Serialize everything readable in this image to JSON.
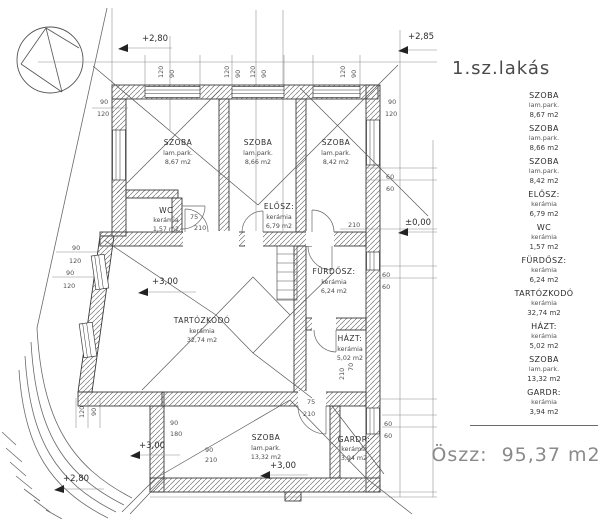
{
  "title": "1.sz.lakás",
  "plan": {
    "rooms": [
      {
        "name": "SZOBA",
        "material": "lam.park.",
        "area": "8,67  m2"
      },
      {
        "name": "SZOBA",
        "material": "lam.park.",
        "area": "8,66  m2"
      },
      {
        "name": "SZOBA",
        "material": "lam.park.",
        "area": "8,42  m2"
      },
      {
        "name": "WC",
        "material": "kerámia",
        "area": "1,57  m2"
      },
      {
        "name": "ELŐSZ:",
        "material": "kerámia",
        "area": "6,79  m2"
      },
      {
        "name": "FÜRDŐSZ:",
        "material": "kerámia",
        "area": "6,24  m2"
      },
      {
        "name": "TARTÓZKODÓ",
        "material": "kerámia",
        "area": "32,74  m2"
      },
      {
        "name": "HÁZT:",
        "material": "kerámia",
        "area": "5,02  m2"
      },
      {
        "name": "SZOBA",
        "material": "lam.park.",
        "area": "13,32  m2"
      },
      {
        "name": "GARDR:",
        "material": "kerámia",
        "area": "3,94  m2"
      }
    ],
    "levels": {
      "top_left": "+2,80",
      "top_right": "+2,85",
      "datum": "±0,00",
      "living": "+3,00",
      "terrace": "+3,00",
      "bottom_room": "+3,00",
      "garden": "+2,80"
    },
    "dims": [
      "120",
      "90",
      "120",
      "90",
      "120",
      "90",
      "120",
      "90",
      "90",
      "120",
      "90",
      "120",
      "90",
      "120",
      "90",
      "120",
      "60",
      "60",
      "60",
      "60",
      "60",
      "60",
      "75",
      "210",
      "75",
      "210",
      "210",
      "70",
      "120",
      "90",
      "90",
      "180",
      "90",
      "210",
      "210"
    ]
  },
  "legend": {
    "items": [
      {
        "name": "SZOBA",
        "material": "lam.park.",
        "area": "8,67  m2"
      },
      {
        "name": "SZOBA",
        "material": "lam.park.",
        "area": "8,66  m2"
      },
      {
        "name": "SZOBA",
        "material": "lam.park.",
        "area": "8,42  m2"
      },
      {
        "name": "ELŐSZ:",
        "material": "kerámia",
        "area": "6,79  m2"
      },
      {
        "name": "WC",
        "material": "kerámia",
        "area": "1,57  m2"
      },
      {
        "name": "FÜRDŐSZ:",
        "material": "kerámia",
        "area": "6,24  m2"
      },
      {
        "name": "TARTÓZKODÓ",
        "material": "kerámia",
        "area": "32,74  m2"
      },
      {
        "name": "HÁZT:",
        "material": "kerámia",
        "area": "5,02  m2"
      },
      {
        "name": "SZOBA",
        "material": "lam.park.",
        "area": "13,32  m2"
      },
      {
        "name": "GARDR:",
        "material": "kerámia",
        "area": "3,94  m2"
      }
    ],
    "total_label": "Öszz:",
    "total_value": "95,37  m2"
  }
}
